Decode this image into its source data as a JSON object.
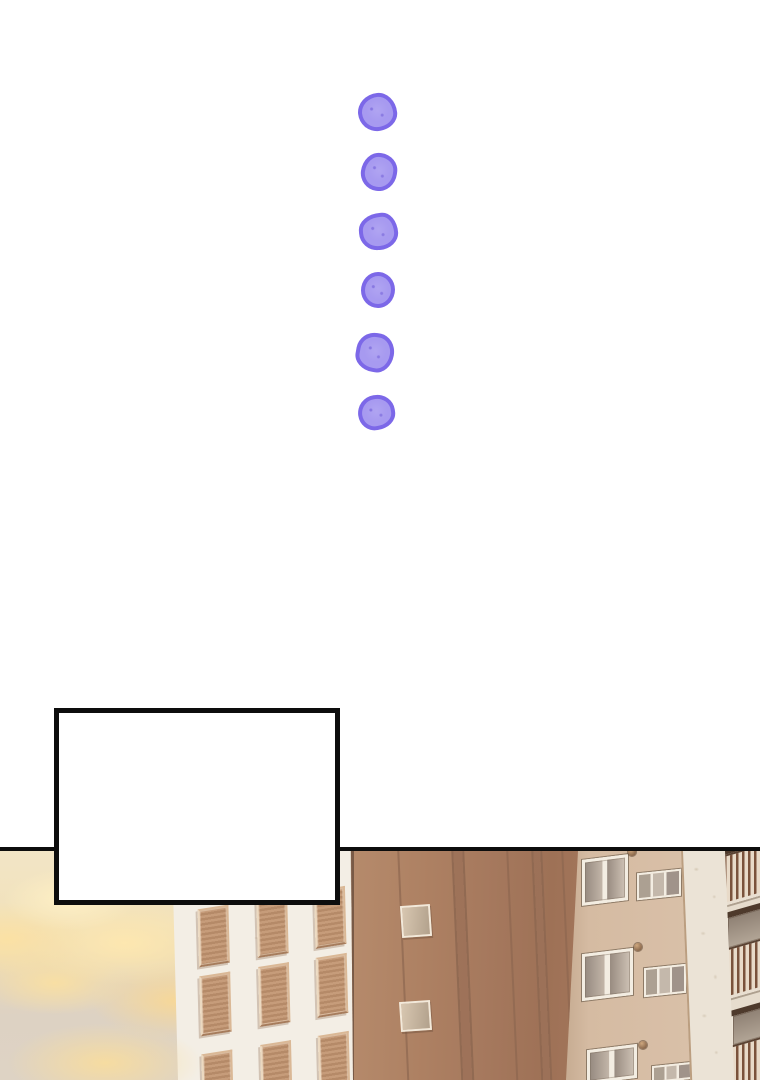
{
  "page": {
    "kind": "webtoon-comic-page",
    "background": "#ffffff"
  },
  "palette": {
    "ink": "#0d0d0d",
    "purple_fill": "#a79af0",
    "purple_line": "#7c68e8",
    "sky_cream": "#f2e5c6",
    "cloud_gold": "#fbe3a8",
    "sky_gray": "#ddd2c3",
    "bldg_white": "#f3eee5",
    "shutter_light": "#c69c7a",
    "shutter_dark": "#b58a68",
    "brown_light": "#b68b6c",
    "brown_dark": "#9e7156",
    "brown_edge": "#6f5140",
    "tan": "#d9c0a8",
    "frame_white": "#f3ede2",
    "strip_white": "#ebe3d6",
    "rail_brown": "#7a523b",
    "bar_dark": "#4e3a2c"
  },
  "speech_box": {
    "text": ""
  },
  "speech_blobs": {
    "count": 6,
    "items": [
      {
        "x": 358,
        "y": 93,
        "w": 39,
        "h": 38,
        "radius": "54% 46% 52% 48% / 50% 56% 44% 50%",
        "rot": -6
      },
      {
        "x": 361,
        "y": 153,
        "w": 36,
        "h": 38,
        "radius": "48% 52% 50% 50% / 55% 45% 52% 48%",
        "rot": 8
      },
      {
        "x": 359,
        "y": 213,
        "w": 39,
        "h": 37,
        "radius": "60% 40% 52% 48% / 46% 58% 46% 50%",
        "rot": -4
      },
      {
        "x": 361,
        "y": 272,
        "w": 34,
        "h": 36,
        "radius": "50% 50% 50% 50% / 51% 49% 51% 49%",
        "rot": 0
      },
      {
        "x": 356,
        "y": 333,
        "w": 38,
        "h": 39,
        "radius": "52% 48% 45% 55% / 49% 53% 55% 43%",
        "rot": 10
      },
      {
        "x": 358,
        "y": 395,
        "w": 37,
        "h": 35,
        "radius": "50% 50% 55% 45% / 54% 50% 46% 50%",
        "rot": -8
      }
    ]
  },
  "panel": {
    "shutter_windows": [
      {
        "x": 24,
        "y": 59,
        "h": 58
      },
      {
        "x": 83,
        "y": 59,
        "h": 58
      },
      {
        "x": 141,
        "y": 59,
        "h": 58
      },
      {
        "x": 24,
        "y": 126,
        "h": 60
      },
      {
        "x": 83,
        "y": 126,
        "h": 60
      },
      {
        "x": 141,
        "y": 126,
        "h": 60
      },
      {
        "x": 24,
        "y": 204,
        "h": 58
      },
      {
        "x": 83,
        "y": 204,
        "h": 58
      },
      {
        "x": 141,
        "y": 204,
        "h": 58
      }
    ],
    "brown_seams": [
      {
        "x": 49,
        "w": 2,
        "kind": "line"
      },
      {
        "x": 103,
        "w": 13,
        "kind": "band"
      },
      {
        "x": 158,
        "w": 2,
        "kind": "line"
      },
      {
        "x": 183,
        "w": 11,
        "kind": "band"
      },
      {
        "x": 213,
        "w": 2,
        "kind": "line"
      }
    ],
    "brown_windows": [
      {
        "x": 53,
        "y": 54,
        "w": 30,
        "h": 32
      },
      {
        "x": 52,
        "y": 150,
        "w": 31,
        "h": 30
      }
    ],
    "tan_double_windows": [
      {
        "x": 22,
        "y": 6,
        "w": 46,
        "h": 46
      },
      {
        "x": 22,
        "y": 100,
        "w": 51,
        "h": 47
      },
      {
        "x": 27,
        "y": 196,
        "w": 50,
        "h": 34
      }
    ],
    "tan_wide_windows": [
      {
        "x": 77,
        "y": 20,
        "w": 44,
        "h": 27
      },
      {
        "x": 84,
        "y": 115,
        "w": 42,
        "h": 29
      },
      {
        "x": 92,
        "y": 213,
        "w": 40,
        "h": 17
      }
    ],
    "tan_vents": [
      {
        "x": 68,
        "y": -3
      },
      {
        "x": 74,
        "y": 92
      },
      {
        "x": 79,
        "y": 190
      }
    ],
    "balcony_units": [
      {
        "x": 2,
        "y": -2,
        "glass": 0,
        "rail": 46
      },
      {
        "x": 3,
        "y": 62,
        "glass": 30,
        "rail": 46
      },
      {
        "x": 8,
        "y": 160,
        "glass": 29,
        "rail": 46
      }
    ]
  }
}
